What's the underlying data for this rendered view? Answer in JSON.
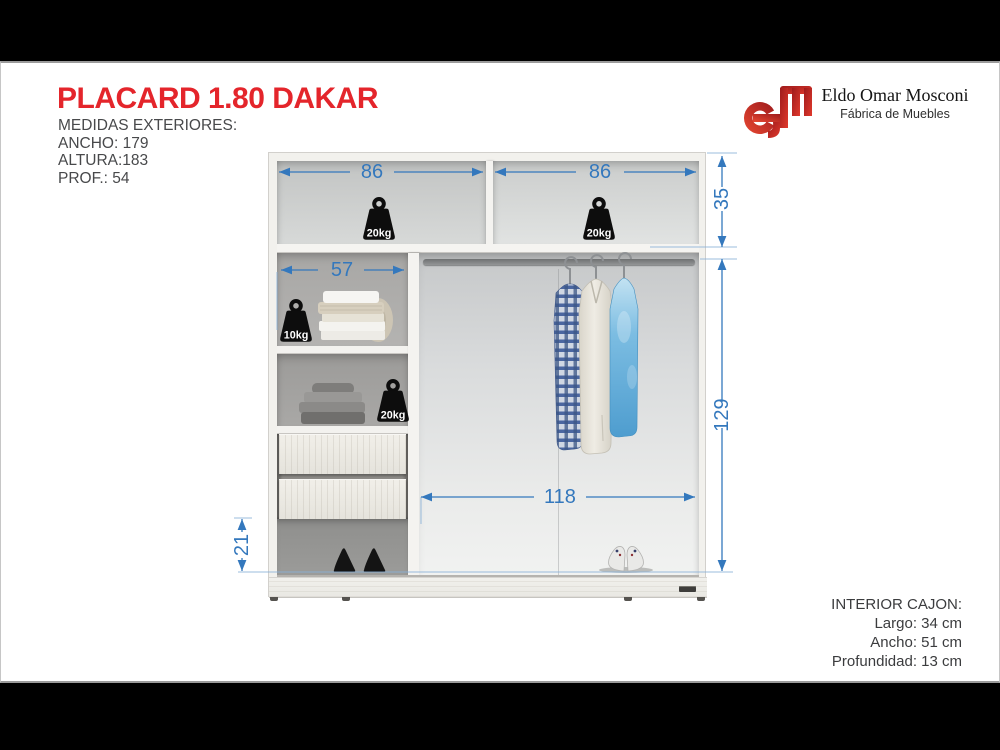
{
  "header": {
    "title": "PLACARD 1.80 DAKAR",
    "specs_title": "MEDIDAS EXTERIORES:",
    "specs": [
      "ANCHO: 179",
      "ALTURA:183",
      "PROF.: 54"
    ]
  },
  "brand": {
    "name": "Eldo Omar Mosconi",
    "tagline": "Fábrica de Muebles"
  },
  "diagram": {
    "dimensions": {
      "top_left_width": "86",
      "top_right_width": "86",
      "top_section_height": "35",
      "left_shelf_width": "57",
      "hanging_section_height": "129",
      "hanging_section_width": "118",
      "bottom_space_height": "21"
    },
    "weights": {
      "top_left_shelf": "20kg",
      "top_right_shelf": "20kg",
      "towel_shelf": "10kg",
      "clothes_shelf": "20kg"
    }
  },
  "drawer_info": {
    "title": "INTERIOR CAJON:",
    "lines": [
      "Largo: 34 cm",
      "Ancho: 51 cm",
      "Profundidad: 13 cm"
    ]
  },
  "colors": {
    "title_red": "#e4252b",
    "dimension_blue": "#3478bd",
    "logo_red": "#c4262a"
  }
}
